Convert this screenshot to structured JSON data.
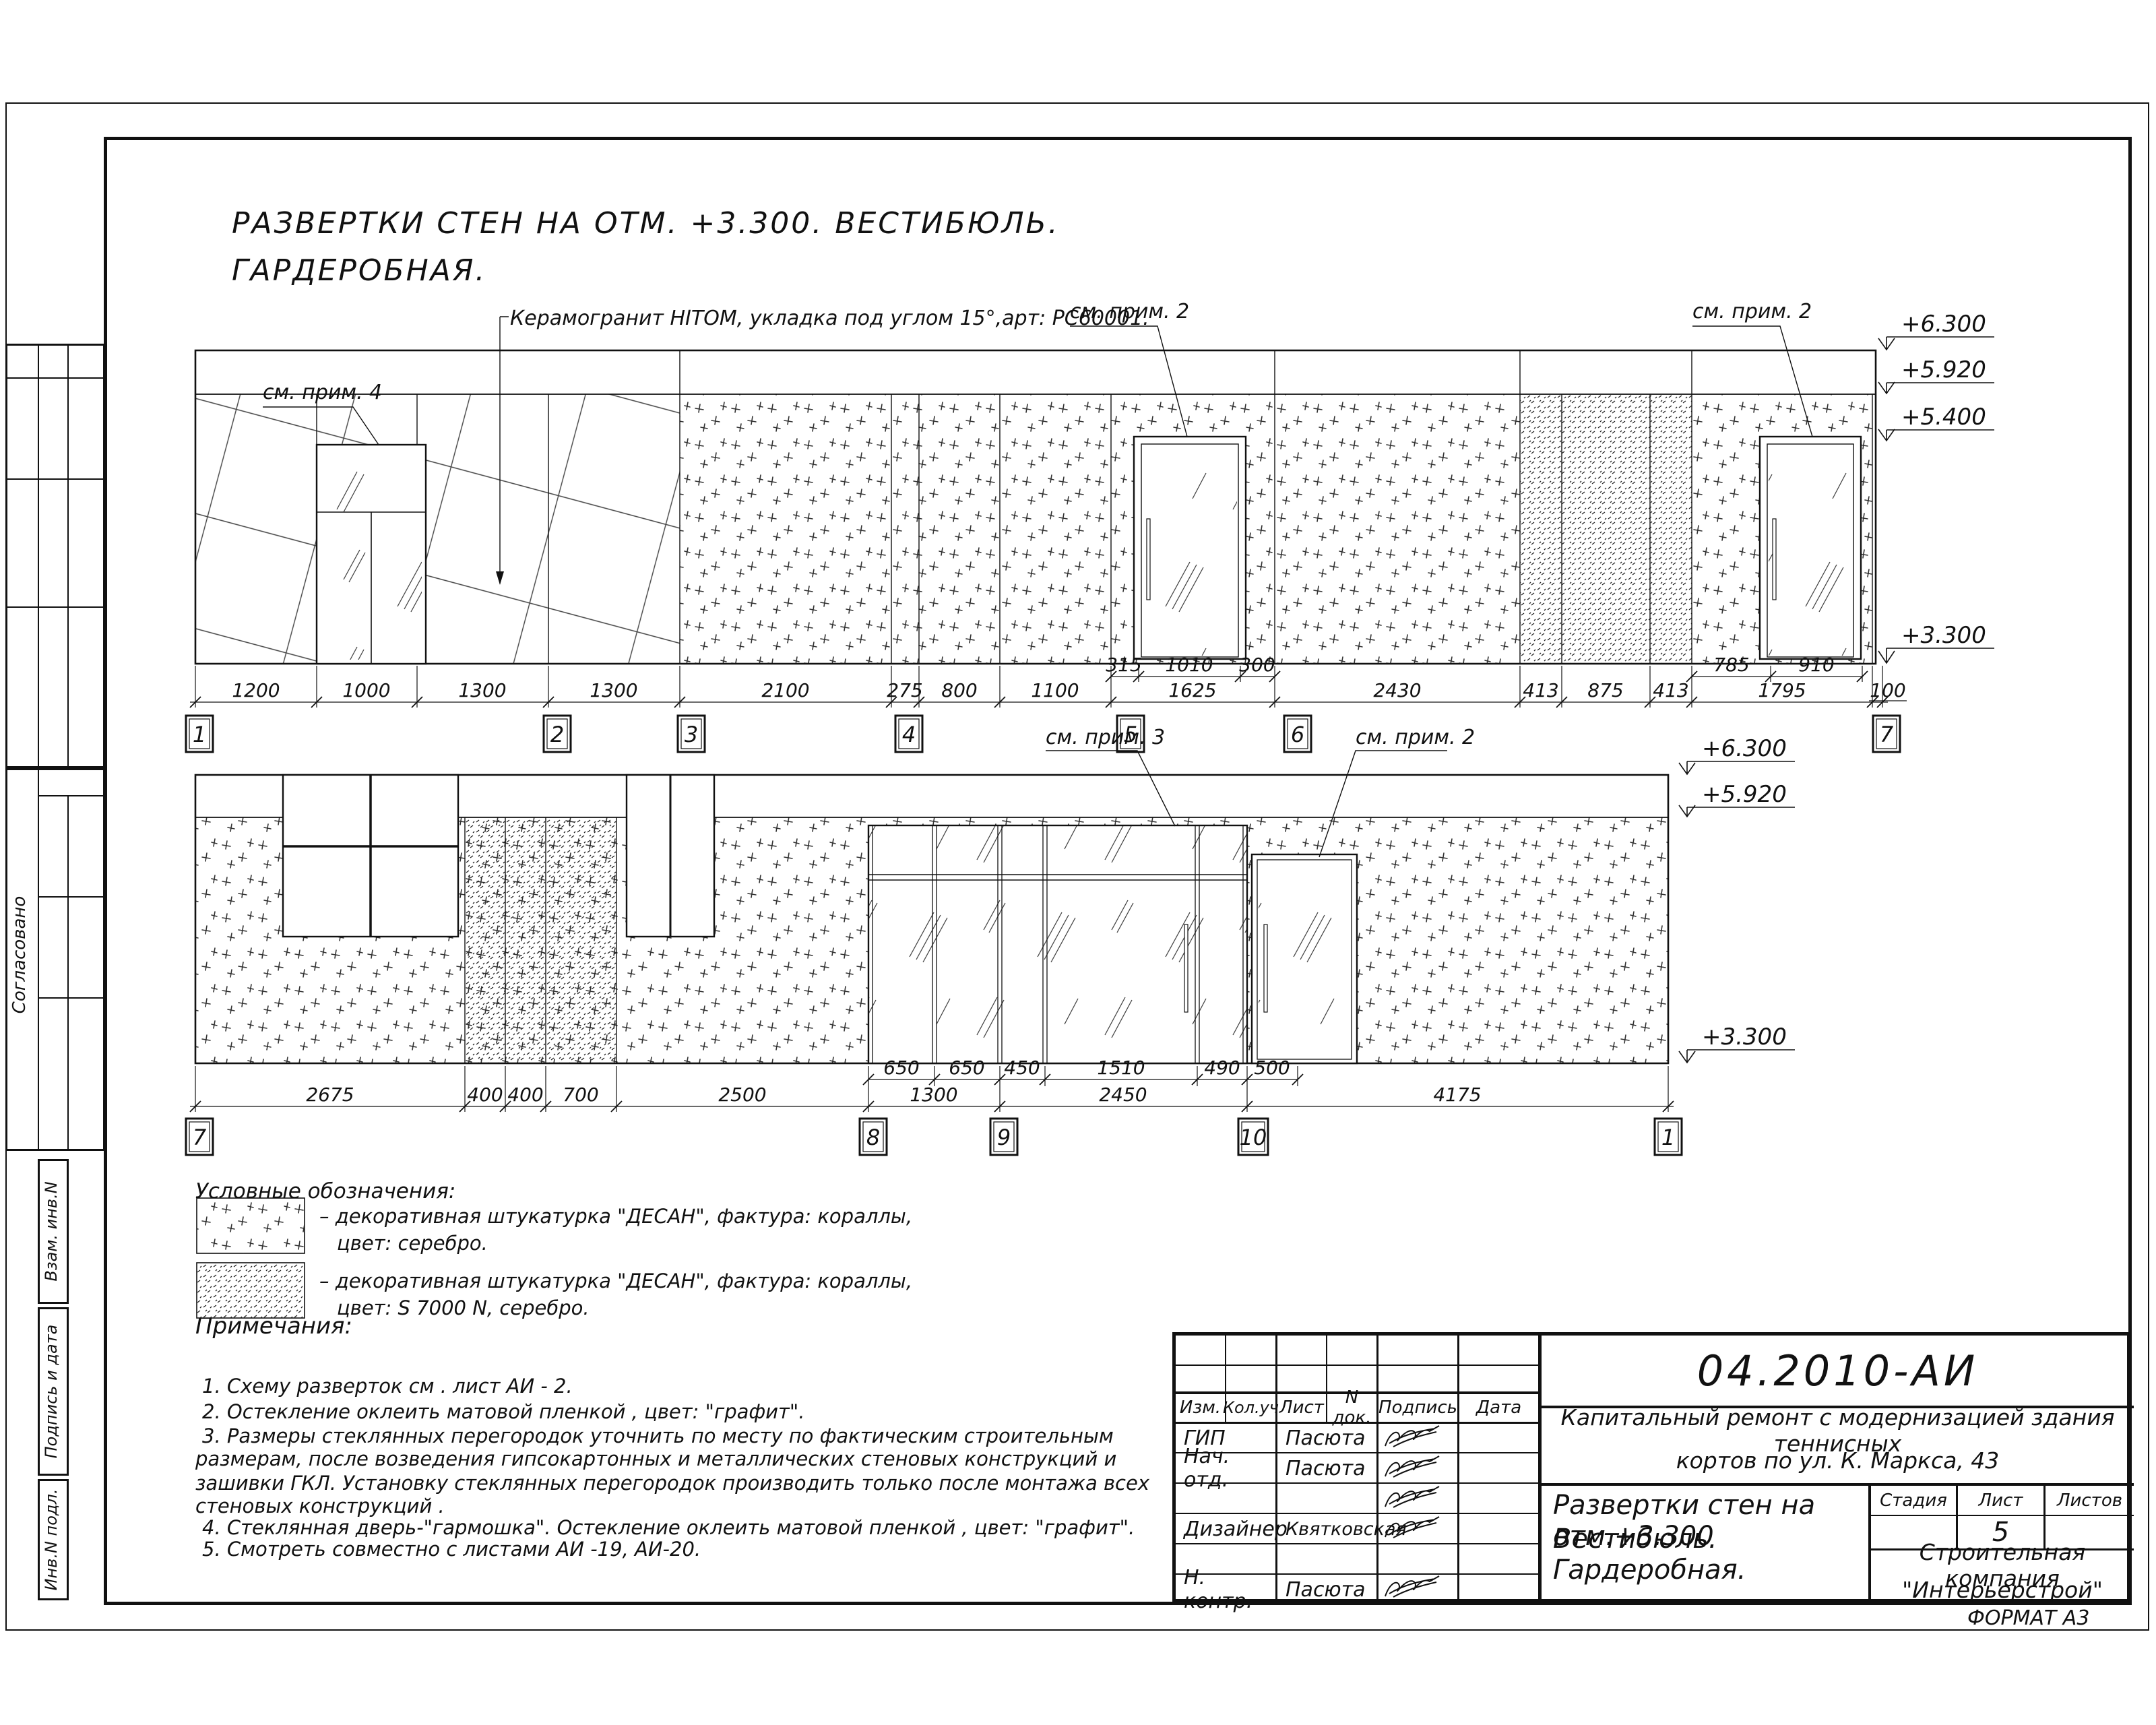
{
  "page": {
    "title_line1": "РАЗВЕРТКИ СТЕН НА ОТМ. +3.300. ВЕСТИБЮЛЬ.",
    "title_line2": "ГАРДЕРОБНАЯ.",
    "format_label": "ФОРМАТ А3"
  },
  "sidebar": {
    "soglasovano": "Согласовано",
    "vzam": "Взам. инв.N",
    "podpis": "Подпись и дата",
    "inv": "Инв.N подл."
  },
  "elev1": {
    "annotations": {
      "note4": "см. прим. 4",
      "ceramic": "Керамогранит HITOM, укладка под углом 15°,арт: PC60001.",
      "note2a": "см. прим. 2",
      "note2b": "см. прим. 2"
    },
    "marks": [
      "+6.300",
      "+5.920",
      "+5.400",
      "+3.300"
    ],
    "dims_main": [
      "1200",
      "1000",
      "1300",
      "1300",
      "2100",
      "275",
      "800",
      "1100",
      "1625",
      "2430",
      "413",
      "875",
      "413",
      "1795",
      "100"
    ],
    "dims_sub": [
      "315",
      "1010",
      "300",
      "785",
      "910"
    ],
    "axes": [
      "1",
      "2",
      "3",
      "4",
      "5",
      "6",
      "7"
    ]
  },
  "elev2": {
    "annotations": {
      "note3": "см. прим. 3",
      "note2": "см. прим. 2"
    },
    "marks": [
      "+6.300",
      "+5.920",
      "+3.300"
    ],
    "dims_main": [
      "2675",
      "400",
      "400",
      "700",
      "2500",
      "1300",
      "2450",
      "4175"
    ],
    "dims_sub": [
      "650",
      "650",
      "450",
      "1510",
      "490",
      "500"
    ],
    "axes": [
      "7",
      "8",
      "9",
      "10",
      "1"
    ]
  },
  "legend": {
    "heading": "Условные обозначения:",
    "items": [
      {
        "line1": "– декоративная штукатурка \"ДЕСАН\", фактура: кораллы,",
        "line2": "цвет: серебро."
      },
      {
        "line1": "– декоративная штукатурка \"ДЕСАН\", фактура: кораллы,",
        "line2": "цвет: S 7000 N, серебро."
      }
    ]
  },
  "notes": {
    "heading": "Примечания:",
    "lines": [
      "1. Схему разверток см . лист АИ - 2.",
      "2. Остекление оклеить матовой пленкой , цвет: \"графит\".",
      "3. Размеры стеклянных перегородок уточнить по месту по фактическим строительным",
      "размерам, после возведения гипсокартонных и металлических стеновых конструкций и",
      "зашивки ГКЛ. Установку стеклянных перегородок производить только после монтажа всех",
      "стеновых конструкций .",
      "4. Стеклянная дверь-\"гармошка\". Остекление оклеить матовой пленкой , цвет: \"графит\".",
      "5. Смотреть совместно с листами АИ -19, АИ-20."
    ]
  },
  "titleblock": {
    "doc_number": "04.2010-АИ",
    "project": [
      "Капитальный ремонт с модернизацией здания теннисных",
      "кортов по ул. К. Маркса, 43"
    ],
    "sheet_title": [
      "Развертки стен на отм.+3.300",
      "Вестибюль. Гардеробная."
    ],
    "company": [
      "Строительная компания",
      "\"Интерьерстрой\""
    ],
    "header": [
      "Изм.",
      "Кол.уч",
      "Лист",
      "N док.",
      "Подпись",
      "Дата"
    ],
    "stage_header": [
      "Стадия",
      "Лист",
      "Листов"
    ],
    "sheet_number": "5",
    "rows": [
      {
        "role": "ГИП",
        "name": "Пасюта"
      },
      {
        "role": "Нач. отд.",
        "name": "Пасюта"
      },
      {
        "role": "",
        "name": ""
      },
      {
        "role": "Дизайнер",
        "name": "Квятковская"
      },
      {
        "role": "",
        "name": ""
      },
      {
        "role": "Н. контр.",
        "name": "Пасюта"
      }
    ]
  },
  "colors": {
    "ink": "#111111",
    "paper": "#ffffff"
  }
}
